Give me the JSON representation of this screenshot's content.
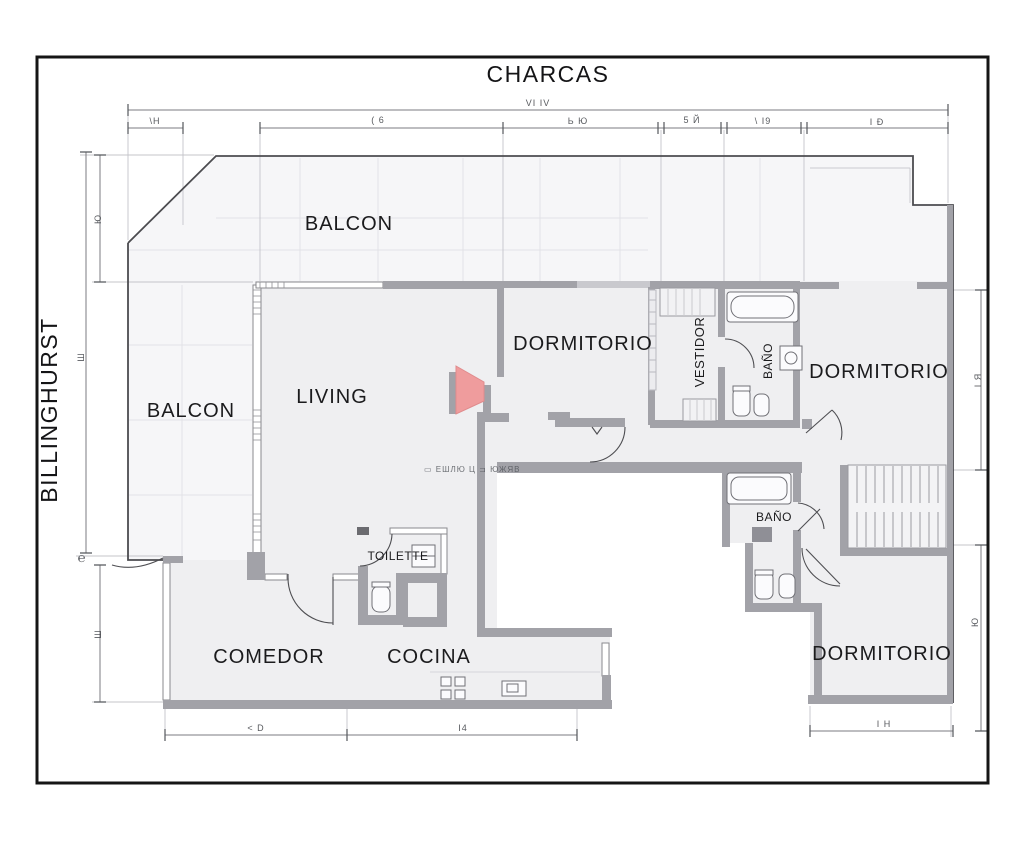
{
  "streets": {
    "top": "CHARCAS",
    "left": "BILLINGHURST"
  },
  "rooms": {
    "balcon_top": "BALCON",
    "balcon_left": "BALCON",
    "living": "LIVING",
    "dormitorio_1": "DORMITORIO",
    "vestidor": "VESTIDOR",
    "bano_1": "BAÑO",
    "dormitorio_2": "DORMITORIO",
    "bano_2": "BAÑO",
    "toilette": "TOILETTE",
    "comedor": "COMEDOR",
    "cocina": "COCINA",
    "dormitorio_3": "DORMITORIO"
  },
  "dimensions": {
    "top_overall": "VI IV",
    "top_seg_1": "\\H",
    "top_seg_2": "( 6",
    "top_seg_3": "Ь Ю",
    "top_seg_4": "5 Й",
    "top_seg_5": "\\ I9",
    "top_seg_6": "I Ð",
    "left_1": "Ю",
    "left_2": "Ш",
    "left_3": "Ш",
    "left_mark": "℮",
    "right_1": "I Я",
    "right_2": "Ю",
    "bottom_1": "< D",
    "bottom_2": "I4",
    "bottom_3": "I H",
    "hall_note": "▭ ЕШЛЮ Ц ⊐ ЮЖЯВ"
  },
  "colors": {
    "wall": "#a2a2a8",
    "room_fill": "#efeff1",
    "balcony_fill": "#f6f6f8",
    "door_highlight": "#ef9c9d",
    "frame": "#151515",
    "dim_line": "#7b7b80"
  }
}
